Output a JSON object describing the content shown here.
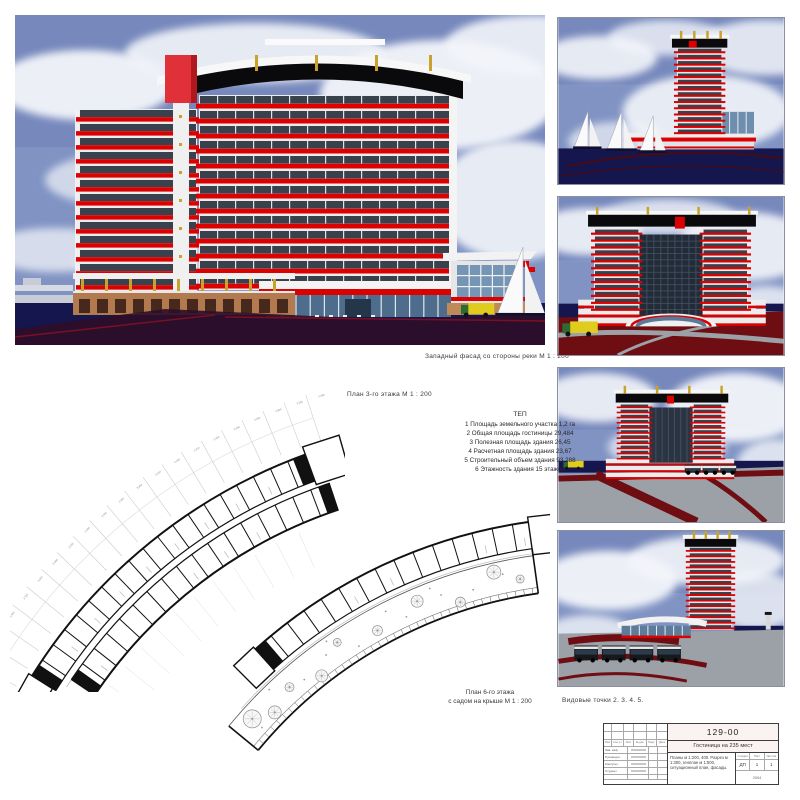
{
  "colors": {
    "accent_red": "#dd0000",
    "sky_blue": "#8093c3",
    "cloud": "#f3f5fa",
    "water_navy": "#15164e",
    "plaza_red": "#6e0d12",
    "plaza_gray": "#9ba1a7",
    "window_dark": "#39414d",
    "crown_black": "#0a0a0c",
    "gold": "#c9a22c"
  },
  "captions": {
    "main_view": "Западный фасад со стороны реки М 1 : 200",
    "plan3": "План 3-го этажа М 1 : 200",
    "plan6_line1": "План 6-го этажа",
    "plan6_line2": "с садом на крыше М 1 : 200",
    "viewpoints": "Видовые точки 2. 3. 4. 5."
  },
  "tep": {
    "title": "ТЕП",
    "lines": [
      "1 Площадь земельного участка 1,2 га",
      "2 Общая площадь гостиницы 29,484",
      "3 Полезная площадь здания 26,45",
      "4 Расчетная площадь здания 23,67",
      "5 Строительный объем здания 93,288",
      "6 Этажность здания 15 этажей"
    ]
  },
  "plans": {
    "dimension_label": "3,300"
  },
  "title_block": {
    "code": "129-00",
    "project_title": "Гостиница на 235 мест",
    "sheet_contents": "Планы м 1:200, 400. Разрез м 1:300, генплан м 1:500, ситуационный план, фасады.",
    "stage_label": "Стадия",
    "sheet_label": "Лист",
    "sheets_label": "Листов",
    "stage_value": "ДП",
    "sheet_value": "1",
    "sheets_value": "1",
    "year": "2004",
    "header_cells": [
      "Изм",
      "Кол.уч",
      "Лист",
      "№ док.",
      "Подп.",
      "Дата"
    ],
    "roles": [
      "Зав. каф.",
      "Руководит.",
      "Консульт.",
      "Студент"
    ]
  }
}
